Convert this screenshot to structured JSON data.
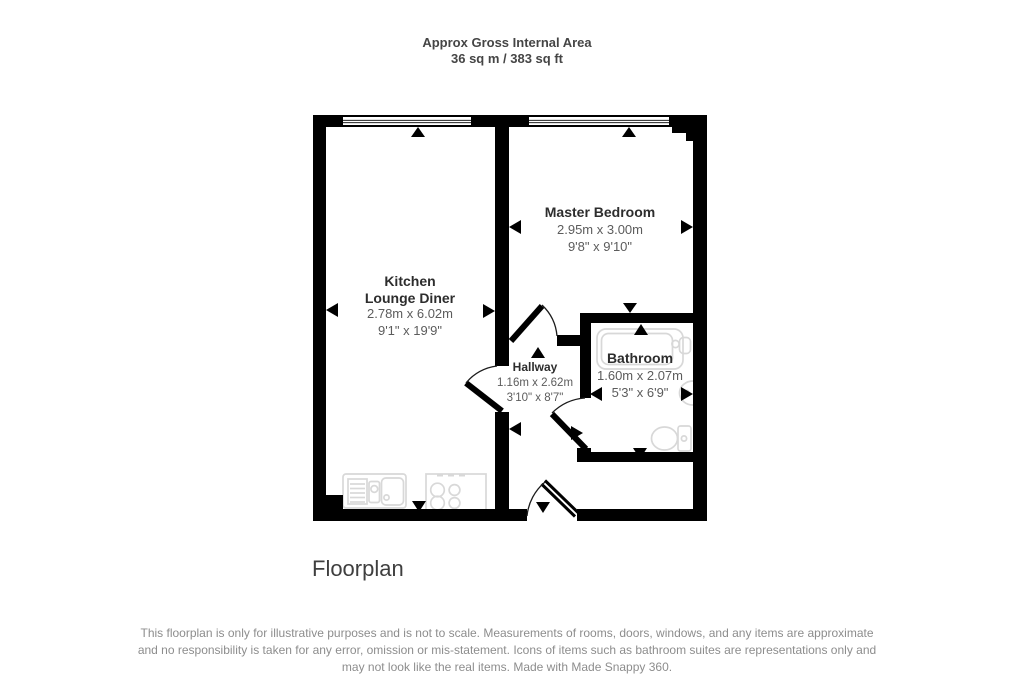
{
  "header": {
    "title": "Approx Gross Internal Area",
    "area": "36 sq m / 383 sq ft"
  },
  "rooms": {
    "kitchen": {
      "name_line1": "Kitchen",
      "name_line2": "Lounge Diner",
      "metric": "2.78m x 6.02m",
      "imperial": "9'1\" x 19'9\""
    },
    "bedroom": {
      "name": "Master Bedroom",
      "metric": "2.95m x 3.00m",
      "imperial": "9'8\" x 9'10\""
    },
    "hallway": {
      "name": "Hallway",
      "metric": "1.16m x 2.62m",
      "imperial": "3'10\" x 8'7\""
    },
    "bathroom": {
      "name": "Bathroom",
      "metric": "1.60m x 2.07m",
      "imperial": "5'3\" x 6'9\""
    }
  },
  "caption": "Floorplan",
  "disclaimer": {
    "line1": "This floorplan is only for illustrative purposes and is not to scale. Measurements of rooms, doors, windows, and any items are approximate",
    "line2": "and no responsibility is taken for any error, omission or mis-statement. Icons of items such as bathroom suites are representations only and",
    "line3": "may not look like the real items. Made with Made Snappy 360."
  },
  "colors": {
    "wall": "#000000",
    "fixture_outline": "#d8d8d8",
    "room_name_text": "#2d2d2d",
    "dimension_text": "#5c5c5c",
    "header_text": "#454545",
    "caption_text": "#3f3f3f",
    "disclaimer_text": "#8d8d8d"
  }
}
